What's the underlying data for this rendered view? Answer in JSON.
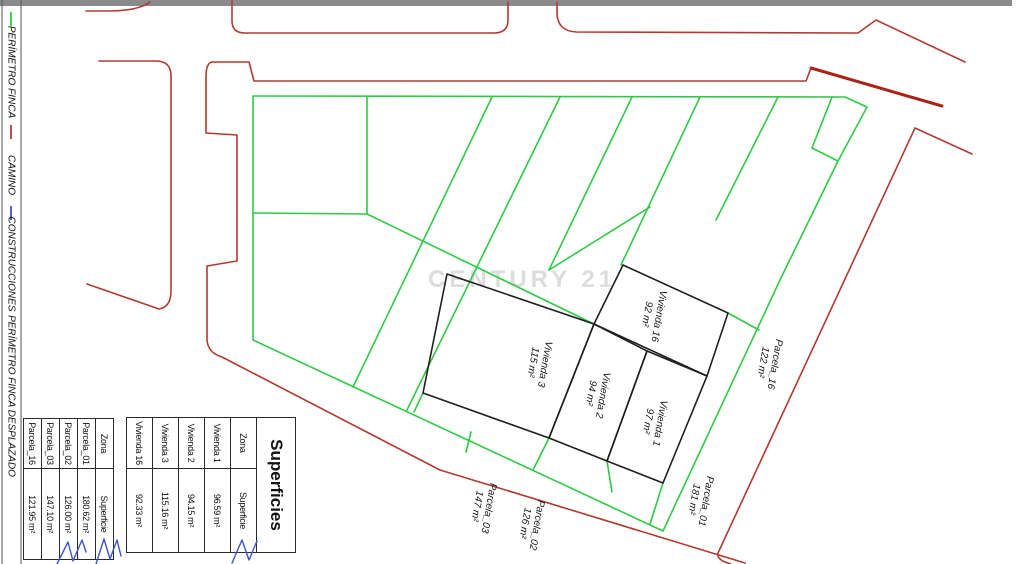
{
  "legend": {
    "items": [
      {
        "label": "PERÍMETRO FINCA",
        "color": "#2fca45"
      },
      {
        "label": "CAMINO",
        "color": "#b13a30"
      },
      {
        "label": "CONSTRUCCIONES",
        "color": "#3a55c8"
      },
      {
        "label": "PERÍMETRO FINCA DESPLAZADO",
        "color": "#1f1f1f"
      }
    ]
  },
  "watermark": "CENTURY 21",
  "plan_labels": {
    "vivienda16": {
      "name": "Vivienda 16",
      "area": "92 m²"
    },
    "vivienda3": {
      "name": "Vivienda 3",
      "area": "115 m²"
    },
    "vivienda2": {
      "name": "Vivienda 2",
      "area": "94 m²"
    },
    "vivienda1": {
      "name": "Vivienda 1",
      "area": "97 m²"
    },
    "parcela16": {
      "name": "Parcela_16",
      "area": "122 m²"
    },
    "parcela01": {
      "name": "Parcela_01",
      "area": "181 m²"
    },
    "parcela02": {
      "name": "Parcela_02",
      "area": "126 m²"
    },
    "parcela03": {
      "name": "Parcela_03",
      "area": "147 m²"
    }
  },
  "tables": {
    "superficies": {
      "title": "Superficies",
      "headers": {
        "zona": "Zona",
        "superficie": "Superficie"
      },
      "rows": [
        {
          "zona": "Vivienda 1",
          "superficie": "96.59 m²"
        },
        {
          "zona": "Vivienda 2",
          "superficie": "94.15 m²"
        },
        {
          "zona": "Vivienda 3",
          "superficie": "115.16 m²"
        },
        {
          "zona": "Vivienda 16",
          "superficie": "92.33 m²"
        }
      ]
    },
    "parcelas": {
      "headers": {
        "zona": "Zona",
        "superficie": "Superficie"
      },
      "rows": [
        {
          "zona": "Parcela_01",
          "superficie": "180.62 m²"
        },
        {
          "zona": "Parcela_02",
          "superficie": "126.00 m²"
        },
        {
          "zona": "Parcela_03",
          "superficie": "147.10 m²"
        },
        {
          "zona": "Parcela_16",
          "superficie": "121.95 m²"
        }
      ]
    }
  },
  "colors": {
    "parcel_green": "#2fca45",
    "road_red": "#b13a30",
    "road_red_thick": "#ab2217",
    "construction_blue": "#3a55c8",
    "building_black": "#1f1f1f",
    "watermark_gray": "#dcdcdc",
    "top_bar_gray": "#8a8a8a"
  }
}
